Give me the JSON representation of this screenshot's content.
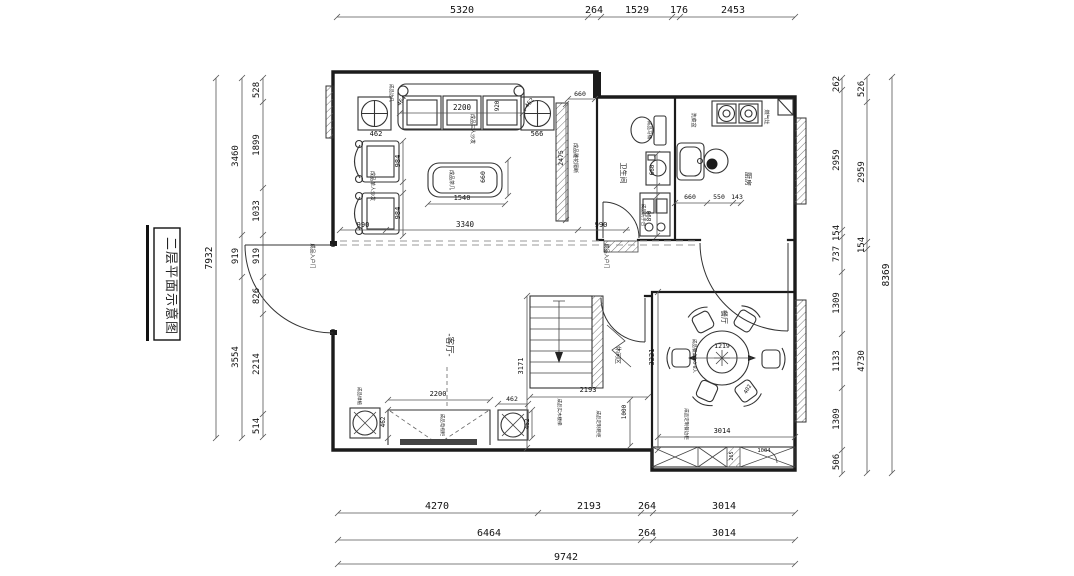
{
  "title": {
    "text": "二层平面示意图"
  },
  "rooms": [
    "客厅",
    "餐厅",
    "厨房",
    "卫生间",
    "休闲区"
  ],
  "dimensions": {
    "top": [
      "5320",
      "264",
      "1529",
      "176",
      "2453"
    ],
    "bottom_row1": [
      "4270",
      "2193",
      "264",
      "3014"
    ],
    "bottom_row2": [
      "6464",
      "264",
      "3014"
    ],
    "bottom_total": "9742",
    "left_inner": [
      "528",
      "1899",
      "1033",
      "919",
      "826",
      "2214",
      "514"
    ],
    "left_middle": [
      "3460",
      "919",
      "3554"
    ],
    "left_total": "7932",
    "right_inner": [
      "262",
      "2959",
      "154",
      "737",
      "1309",
      "1133",
      "1309",
      "506"
    ],
    "right_middle": [
      "526",
      "2959",
      "154",
      "4730"
    ],
    "right_total": "8369"
  },
  "colors": {
    "line": "#1b1b1b",
    "dim_text": "#111",
    "dash": "#999"
  },
  "floor_plan": {
    "texts": [
      {
        "t": "5320",
        "x": 462,
        "y": 13,
        "s": 10
      },
      {
        "t": "264",
        "x": 594,
        "y": 13,
        "s": 10
      },
      {
        "t": "1529",
        "x": 637,
        "y": 13,
        "s": 10
      },
      {
        "t": "176",
        "x": 679,
        "y": 13,
        "s": 10
      },
      {
        "t": "2453",
        "x": 733,
        "y": 13,
        "s": 10
      },
      {
        "t": "4270",
        "x": 437,
        "y": 509,
        "s": 10
      },
      {
        "t": "2193",
        "x": 589,
        "y": 509,
        "s": 10
      },
      {
        "t": "264",
        "x": 647,
        "y": 509,
        "s": 10
      },
      {
        "t": "3014",
        "x": 724,
        "y": 509,
        "s": 10
      },
      {
        "t": "6464",
        "x": 489,
        "y": 536,
        "s": 10
      },
      {
        "t": "264",
        "x": 647,
        "y": 536,
        "s": 10
      },
      {
        "t": "3014",
        "x": 724,
        "y": 536,
        "s": 10
      },
      {
        "t": "9742",
        "x": 566,
        "y": 560,
        "s": 10
      },
      {
        "t": "7932",
        "x": 212,
        "y": 258,
        "r": -90,
        "s": 9.5
      },
      {
        "t": "3460",
        "x": 238,
        "y": 156,
        "r": -90,
        "s": 9
      },
      {
        "t": "919",
        "x": 238,
        "y": 256,
        "r": -90,
        "s": 9
      },
      {
        "t": "3554",
        "x": 238,
        "y": 357,
        "r": -90,
        "s": 9
      },
      {
        "t": "528",
        "x": 259,
        "y": 90,
        "r": -90,
        "s": 9
      },
      {
        "t": "1899",
        "x": 259,
        "y": 145,
        "r": -90,
        "s": 9
      },
      {
        "t": "1033",
        "x": 259,
        "y": 211,
        "r": -90,
        "s": 9
      },
      {
        "t": "919",
        "x": 259,
        "y": 256,
        "r": -90,
        "s": 9
      },
      {
        "t": "826",
        "x": 259,
        "y": 296,
        "r": -90,
        "s": 9
      },
      {
        "t": "2214",
        "x": 259,
        "y": 364,
        "r": -90,
        "s": 9
      },
      {
        "t": "514",
        "x": 259,
        "y": 426,
        "r": -90,
        "s": 9
      },
      {
        "t": "262",
        "x": 839,
        "y": 84,
        "r": -90,
        "s": 9
      },
      {
        "t": "2959",
        "x": 839,
        "y": 160,
        "r": -90,
        "s": 9
      },
      {
        "t": "154",
        "x": 839,
        "y": 233,
        "r": -90,
        "s": 9
      },
      {
        "t": "737",
        "x": 839,
        "y": 254,
        "r": -90,
        "s": 9
      },
      {
        "t": "1309",
        "x": 839,
        "y": 303,
        "r": -90,
        "s": 9
      },
      {
        "t": "1133",
        "x": 839,
        "y": 361,
        "r": -90,
        "s": 9
      },
      {
        "t": "1309",
        "x": 839,
        "y": 419,
        "r": -90,
        "s": 9
      },
      {
        "t": "506",
        "x": 839,
        "y": 462,
        "r": -90,
        "s": 9
      },
      {
        "t": "526",
        "x": 864,
        "y": 89,
        "r": -90,
        "s": 9
      },
      {
        "t": "2959",
        "x": 864,
        "y": 172,
        "r": -90,
        "s": 9
      },
      {
        "t": "154",
        "x": 864,
        "y": 245,
        "r": -90,
        "s": 9
      },
      {
        "t": "4730",
        "x": 864,
        "y": 361,
        "r": -90,
        "s": 9
      },
      {
        "t": "8369",
        "x": 889,
        "y": 275,
        "r": -90,
        "s": 9.5
      },
      {
        "t": "2200",
        "x": 462,
        "y": 110,
        "s": 7.5
      },
      {
        "t": "462",
        "x": 376,
        "y": 136,
        "s": 7
      },
      {
        "t": "566",
        "x": 537,
        "y": 136,
        "s": 7
      },
      {
        "t": "464",
        "x": 403,
        "y": 102,
        "r": -52,
        "s": 6
      },
      {
        "t": "462",
        "x": 531,
        "y": 104,
        "r": -52,
        "s": 6
      },
      {
        "t": "920",
        "x": 499,
        "y": 106,
        "r": -90,
        "s": 6
      },
      {
        "t": "984",
        "x": 400,
        "y": 161,
        "r": -90,
        "s": 7
      },
      {
        "t": "984",
        "x": 400,
        "y": 213,
        "r": -90,
        "s": 7
      },
      {
        "t": "990",
        "x": 363,
        "y": 227,
        "s": 7
      },
      {
        "t": "3340",
        "x": 465,
        "y": 227,
        "s": 7.5
      },
      {
        "t": "990",
        "x": 601,
        "y": 227,
        "s": 7
      },
      {
        "t": "1540",
        "x": 462,
        "y": 200,
        "s": 7
      },
      {
        "t": "660",
        "x": 485,
        "y": 177,
        "r": -90,
        "s": 6.5
      },
      {
        "t": "660",
        "x": 580,
        "y": 96,
        "s": 6.5
      },
      {
        "t": "2475",
        "x": 563,
        "y": 158,
        "r": -90,
        "s": 6.5
      },
      {
        "t": "成品茶几",
        "x": 450,
        "y": 180,
        "r": 90,
        "s": 5,
        "c": 1,
        "n": "label-tea-table"
      },
      {
        "t": "成品三人沙发",
        "x": 471,
        "y": 129,
        "r": 90,
        "s": 5,
        "c": 1,
        "n": "label-sofa"
      },
      {
        "t": "成品单人沙发",
        "x": 371,
        "y": 186,
        "r": 90,
        "s": 5,
        "c": 1,
        "n": "label-armchair"
      },
      {
        "t": "成品雕花隔断",
        "x": 574,
        "y": 158,
        "r": 90,
        "s": 5,
        "c": 1,
        "n": "label-screen"
      },
      {
        "t": "成品边几",
        "x": 390,
        "y": 93,
        "r": 90,
        "s": 4.5,
        "c": 1,
        "n": "label-side-table"
      },
      {
        "t": "卫生间",
        "x": 621,
        "y": 173,
        "r": 90,
        "s": 7,
        "c": 1,
        "n": "room-bathroom"
      },
      {
        "t": "成品马桶",
        "x": 648,
        "y": 130,
        "r": 90,
        "s": 4.5,
        "c": 1,
        "n": "label-toilet"
      },
      {
        "t": "660",
        "x": 654,
        "y": 170,
        "r": -90,
        "s": 6
      },
      {
        "t": "890",
        "x": 651,
        "y": 216,
        "r": -90,
        "s": 6
      },
      {
        "t": "成品洗手台",
        "x": 642,
        "y": 215,
        "r": 90,
        "s": 4.5,
        "c": 1,
        "n": "label-washstand"
      },
      {
        "t": "厨房",
        "x": 746,
        "y": 179,
        "r": 90,
        "s": 7,
        "c": 1,
        "n": "room-kitchen"
      },
      {
        "t": "燃气灶",
        "x": 765,
        "y": 117,
        "r": 90,
        "s": 5,
        "c": 1,
        "n": "label-gas-stove"
      },
      {
        "t": "洗菜盆",
        "x": 692,
        "y": 120,
        "r": 90,
        "s": 5,
        "c": 1,
        "n": "label-sink"
      },
      {
        "t": "660",
        "x": 690,
        "y": 199,
        "s": 6.5
      },
      {
        "t": "550",
        "x": 719,
        "y": 199,
        "s": 6.5
      },
      {
        "t": "143",
        "x": 737,
        "y": 199,
        "s": 6.5
      },
      {
        "t": "成品入户门",
        "x": 311,
        "y": 256,
        "r": 90,
        "s": 5,
        "c": 1,
        "n": "label-entry-door-left"
      },
      {
        "t": "成品入户门",
        "x": 605,
        "y": 256,
        "r": 90,
        "s": 5,
        "c": 1,
        "n": "label-entry-door-right"
      },
      {
        "t": "3171",
        "x": 523,
        "y": 366,
        "r": -90,
        "s": 7
      },
      {
        "t": "2193",
        "x": 588,
        "y": 392,
        "s": 7
      },
      {
        "t": "1000",
        "x": 626,
        "y": 412,
        "r": -90,
        "s": 6
      },
      {
        "t": "-客厅-",
        "x": 447,
        "y": 345,
        "r": 90,
        "s": 8.5,
        "c": 1,
        "n": "room-living"
      },
      {
        "t": "休闲区",
        "x": 616,
        "y": 355,
        "r": 90,
        "s": 6,
        "c": 1,
        "n": "room-leisure"
      },
      {
        "t": "成品实木楼梯",
        "x": 558,
        "y": 412,
        "r": 90,
        "s": 4.5,
        "c": 1,
        "n": "label-stairs"
      },
      {
        "t": "成品定制鞋柜",
        "x": 597,
        "y": 424,
        "r": 90,
        "s": 4.5,
        "c": 1,
        "n": "label-shoe-cabinet"
      },
      {
        "t": "2200",
        "x": 438,
        "y": 396,
        "s": 7
      },
      {
        "t": "462",
        "x": 385,
        "y": 422,
        "r": -90,
        "s": 6
      },
      {
        "t": "462",
        "x": 512,
        "y": 401,
        "s": 6.5
      },
      {
        "t": "462",
        "x": 529,
        "y": 424,
        "r": -90,
        "s": 6
      },
      {
        "t": "成品绿植",
        "x": 358,
        "y": 396,
        "r": 90,
        "s": 4.5,
        "c": 1,
        "n": "label-plant"
      },
      {
        "t": "成品电视柜",
        "x": 441,
        "y": 425,
        "r": 90,
        "s": 4.5,
        "c": 1,
        "n": "label-tv-cabinet"
      },
      {
        "t": "餐厅",
        "x": 722,
        "y": 317,
        "r": 90,
        "s": 7,
        "c": 1,
        "n": "room-dining"
      },
      {
        "t": "1219",
        "x": 722,
        "y": 348,
        "s": 6.5
      },
      {
        "t": "成品餐桌2.0-8人",
        "x": 693,
        "y": 356,
        "r": 90,
        "s": 4.5,
        "c": 1,
        "n": "label-dining-table"
      },
      {
        "t": "402",
        "x": 749,
        "y": 390,
        "r": -60,
        "s": 5.5
      },
      {
        "t": "3221",
        "x": 654,
        "y": 357,
        "r": -90,
        "s": 7
      },
      {
        "t": "3014",
        "x": 722,
        "y": 433,
        "s": 7
      },
      {
        "t": "成品定制餐边柜",
        "x": 685,
        "y": 424,
        "r": 90,
        "s": 4.5,
        "c": 1,
        "n": "label-sideboard"
      },
      {
        "t": "265",
        "x": 733,
        "y": 456,
        "r": -90,
        "s": 5
      },
      {
        "t": "1004",
        "x": 764,
        "y": 452,
        "s": 5.5
      }
    ],
    "dim_lines": [
      {
        "o": "h",
        "at": 17,
        "a": 337,
        "b": 795,
        "ticks": [
          337,
          588,
          601,
          672,
          680,
          795
        ]
      },
      {
        "o": "h",
        "at": 513,
        "a": 338,
        "b": 795,
        "ticks": [
          338,
          538,
          641,
          653,
          795
        ]
      },
      {
        "o": "h",
        "at": 540,
        "a": 338,
        "b": 795,
        "ticks": [
          338,
          641,
          653,
          795
        ]
      },
      {
        "o": "h",
        "at": 564,
        "a": 338,
        "b": 795,
        "ticks": [
          338,
          795
        ]
      },
      {
        "o": "h",
        "at": 230,
        "a": 340,
        "b": 630,
        "ticks": [
          340,
          386,
          578,
          626
        ]
      },
      {
        "o": "h",
        "at": 113,
        "a": 400,
        "b": 523,
        "ticks": [
          400,
          523
        ]
      },
      {
        "o": "h",
        "at": 204,
        "a": 428,
        "b": 505,
        "ticks": [
          428,
          505
        ]
      },
      {
        "o": "h",
        "at": 203,
        "a": 675,
        "b": 741,
        "ticks": [
          675,
          707,
          733,
          741
        ]
      },
      {
        "o": "h",
        "at": 397,
        "a": 530,
        "b": 648,
        "ticks": [
          530,
          648
        ]
      },
      {
        "o": "h",
        "at": 437,
        "a": 658,
        "b": 795,
        "ticks": [
          658,
          795
        ]
      },
      {
        "o": "h",
        "at": 400,
        "a": 388,
        "b": 490,
        "ticks": [
          388,
          490
        ]
      },
      {
        "o": "h",
        "at": 404,
        "a": 498,
        "b": 528,
        "ticks": [
          498,
          528
        ]
      },
      {
        "o": "h",
        "at": 99,
        "a": 568,
        "b": 595,
        "ticks": [
          568,
          595
        ]
      },
      {
        "o": "h",
        "at": 358,
        "a": 692,
        "b": 752,
        "ticks": []
      },
      {
        "o": "v",
        "at": 216,
        "a": 78,
        "b": 438,
        "ticks": [
          78,
          438
        ]
      },
      {
        "o": "v",
        "at": 242,
        "a": 78,
        "b": 438,
        "ticks": [
          78,
          235,
          277,
          438
        ]
      },
      {
        "o": "v",
        "at": 263,
        "a": 78,
        "b": 437,
        "ticks": [
          78,
          102,
          188,
          235,
          277,
          314,
          414,
          437
        ]
      },
      {
        "o": "v",
        "at": 842,
        "a": 78,
        "b": 474,
        "ticks": [
          78,
          90,
          230,
          237,
          272,
          334,
          388,
          450,
          474
        ]
      },
      {
        "o": "v",
        "at": 867,
        "a": 77,
        "b": 473,
        "ticks": [
          77,
          102,
          242,
          249,
          473
        ]
      },
      {
        "o": "v",
        "at": 892,
        "a": 77,
        "b": 473,
        "ticks": [
          77,
          473
        ]
      },
      {
        "o": "v",
        "at": 527,
        "a": 296,
        "b": 448,
        "ticks": [
          296,
          448
        ]
      },
      {
        "o": "v",
        "at": 658,
        "a": 292,
        "b": 450,
        "ticks": [
          292,
          450
        ]
      },
      {
        "o": "v",
        "at": 630,
        "a": 400,
        "b": 446,
        "ticks": [
          400,
          446
        ]
      },
      {
        "o": "v",
        "at": 403,
        "a": 141,
        "b": 236,
        "ticks": [
          141,
          182,
          193,
          236
        ]
      },
      {
        "o": "v",
        "at": 508,
        "a": 160,
        "b": 196,
        "ticks": [
          160,
          196
        ]
      },
      {
        "o": "v",
        "at": 566,
        "a": 104,
        "b": 220,
        "ticks": [
          104,
          220
        ]
      },
      {
        "o": "v",
        "at": 657,
        "a": 154,
        "b": 236,
        "ticks": [
          154,
          186,
          196,
          236
        ]
      },
      {
        "o": "v",
        "at": 388,
        "a": 410,
        "b": 438,
        "ticks": [
          410,
          438
        ]
      },
      {
        "o": "v",
        "at": 532,
        "a": 410,
        "b": 438,
        "ticks": [
          410,
          438
        ]
      }
    ]
  }
}
